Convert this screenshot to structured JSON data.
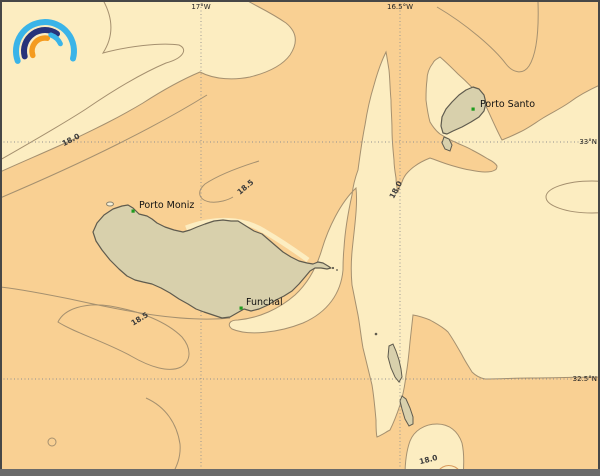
{
  "map": {
    "region": "sea temperature contour map around Madeira and Porto Santo",
    "grid": {
      "meridians": [
        {
          "label": "17°W"
        },
        {
          "label": "16.5°W"
        }
      ],
      "parallels": [
        {
          "label": "33°N"
        },
        {
          "label": "32.5°N"
        }
      ]
    },
    "places": [
      {
        "label": "Porto Santo"
      },
      {
        "label": "Porto Moniz"
      },
      {
        "label": "Funchal"
      }
    ],
    "isotherm_labels": [
      {
        "value": "18.0"
      },
      {
        "value": "18.5"
      },
      {
        "value": "18.5"
      },
      {
        "value": "18.0"
      },
      {
        "value": "18.0"
      }
    ],
    "colors": {
      "band_low": "#fcedc1",
      "band_high": "#f9d093",
      "contour_line": "#a5906f",
      "land_fill": "#d8d0ac",
      "land_outline": "#5f5b4e",
      "grid_line": "#909090",
      "city_marker": "#1e9b1e",
      "frame": "#474747",
      "frame_bottom": "#6a6a6a",
      "logo_cyan": "#3ab4e8",
      "logo_navy": "#27337a",
      "logo_orange": "#f49b1f"
    }
  }
}
